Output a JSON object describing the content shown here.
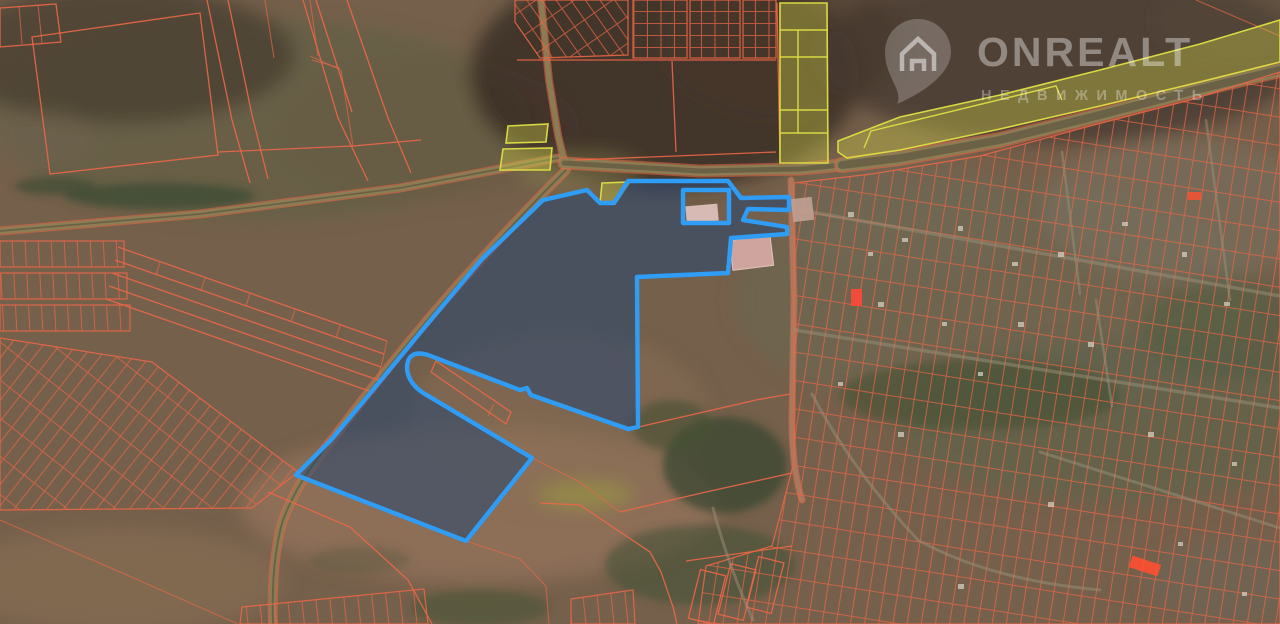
{
  "watermark": {
    "brand": "ONREALT",
    "subtitle": "НЕДВИЖИМОСТЬ",
    "icon": "house-location-pin"
  },
  "map": {
    "description": "Satellite cadastral map with a highlighted land plot for sale",
    "colors": {
      "cad": "#ec6747",
      "cad-bright": "#ff4f33",
      "blue": "#2f9df5",
      "blue-fill": "rgba(38,70,112,0.55)",
      "ylw": "#d9d943",
      "ylw-fill": "rgba(205,205,70,0.38)",
      "road": "#8a8156",
      "road-core": "#4f4c3c",
      "road-light": "#9a9078",
      "terr-base": "#75604b",
      "building-pink": "#cfa49e",
      "roof-light": "#d5cec0"
    }
  }
}
